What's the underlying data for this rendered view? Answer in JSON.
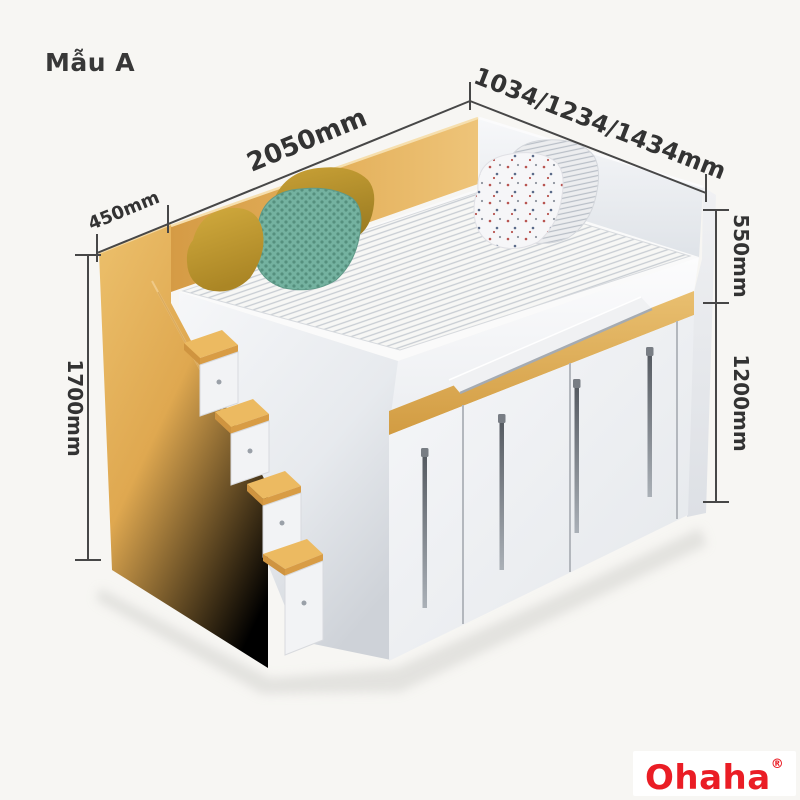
{
  "title": "Mẫu A",
  "dimensions": {
    "stair_depth": "450mm",
    "bed_length": "2050mm",
    "bed_width_options": "1034/1234/1434mm",
    "total_height": "1700mm",
    "upper_section_height": "550mm",
    "cabinet_height": "1200mm"
  },
  "brand": {
    "name": "Ohaha",
    "registered_mark": "®",
    "color": "#ea1d25"
  },
  "scene": {
    "background": "#f7f6f3",
    "wood_color": "#dda74f",
    "accent_strip_color": "#ddab55",
    "dimension_line_color": "#474747"
  }
}
